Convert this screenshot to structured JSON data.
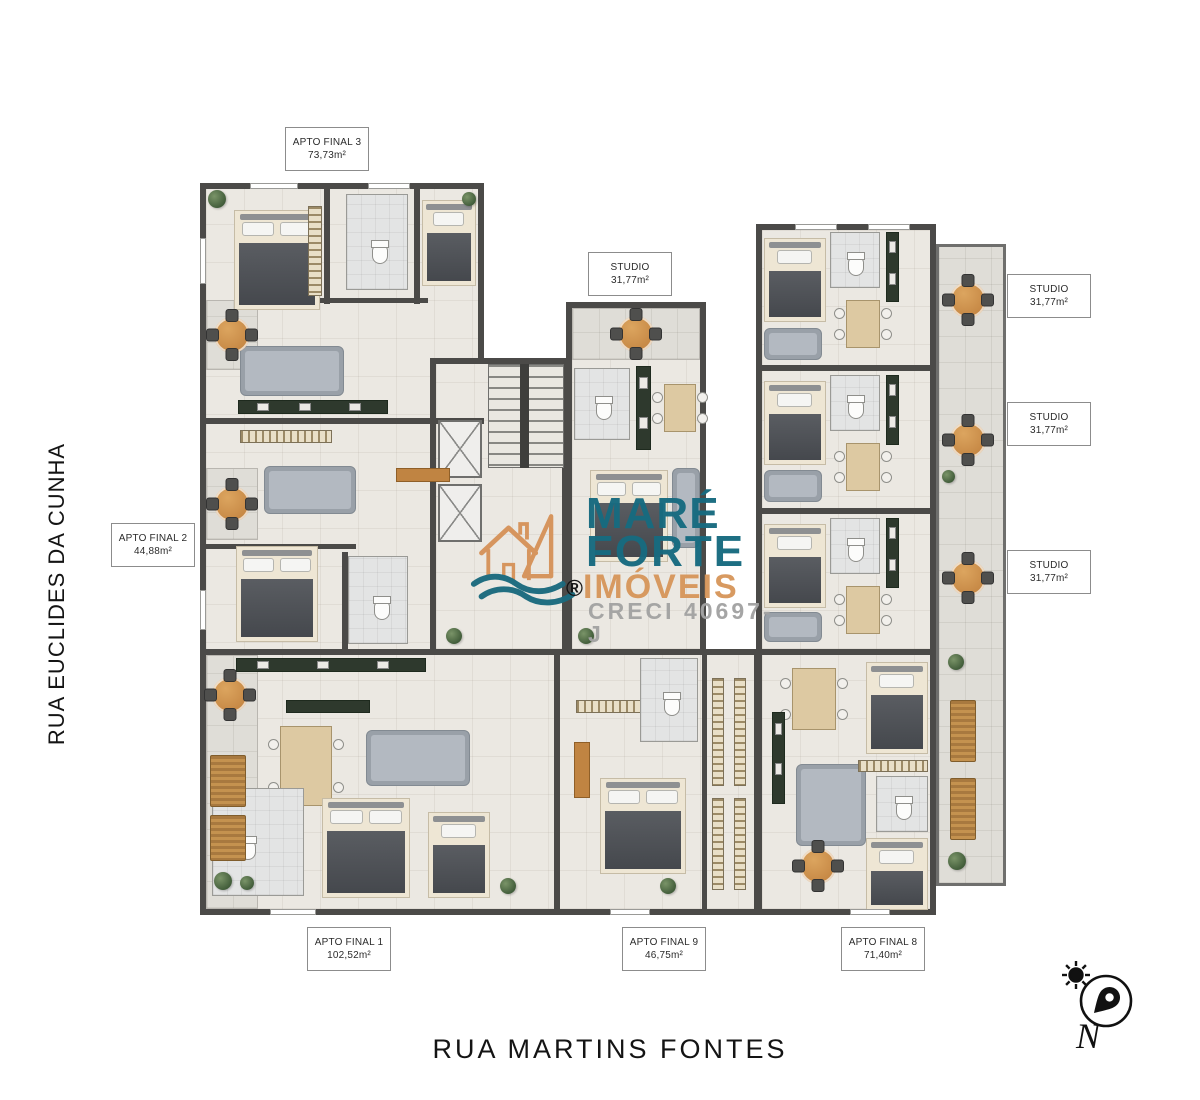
{
  "canvas": {
    "width": 1200,
    "height": 1100,
    "background": "#ffffff"
  },
  "streets": {
    "left_vertical": "RUA EUCLIDES DA CUNHA",
    "bottom_horizontal": "RUA MARTINS FONTES"
  },
  "unit_labels": [
    {
      "name": "APTO FINAL 3",
      "area": "73,73m²"
    },
    {
      "name": "STUDIO",
      "area": "31,77m²"
    },
    {
      "name": "STUDIO",
      "area": "31,77m²"
    },
    {
      "name": "STUDIO",
      "area": "31,77m²"
    },
    {
      "name": "STUDIO",
      "area": "31,77m²"
    },
    {
      "name": "APTO FINAL 2",
      "area": "44,88m²"
    },
    {
      "name": "APTO FINAL 1",
      "area": "102,52m²"
    },
    {
      "name": "APTO FINAL 9",
      "area": "46,75m²"
    },
    {
      "name": "APTO FINAL 8",
      "area": "71,40m²"
    }
  ],
  "watermark": {
    "brand_line1": "MARÉ",
    "brand_line2": "FORTE",
    "brand_line3": "IMÓVEIS",
    "registered_mark": "®",
    "license": "CRECI 40697-J",
    "teal": "#176b80",
    "orange": "#d7975c",
    "license_gray": "#a3a3a3"
  },
  "compass": {
    "north_label": "N"
  },
  "palette": {
    "wall": "#4b4a48",
    "floor": "#ebe8e2",
    "balcony_floor": "#dfddd7",
    "kitchen_green": "#2e392d",
    "wood_orange": "#c4924f",
    "plant_green": "#4d6847",
    "bed_dark": "#54575c",
    "sofa_gray": "#abb1b8"
  }
}
